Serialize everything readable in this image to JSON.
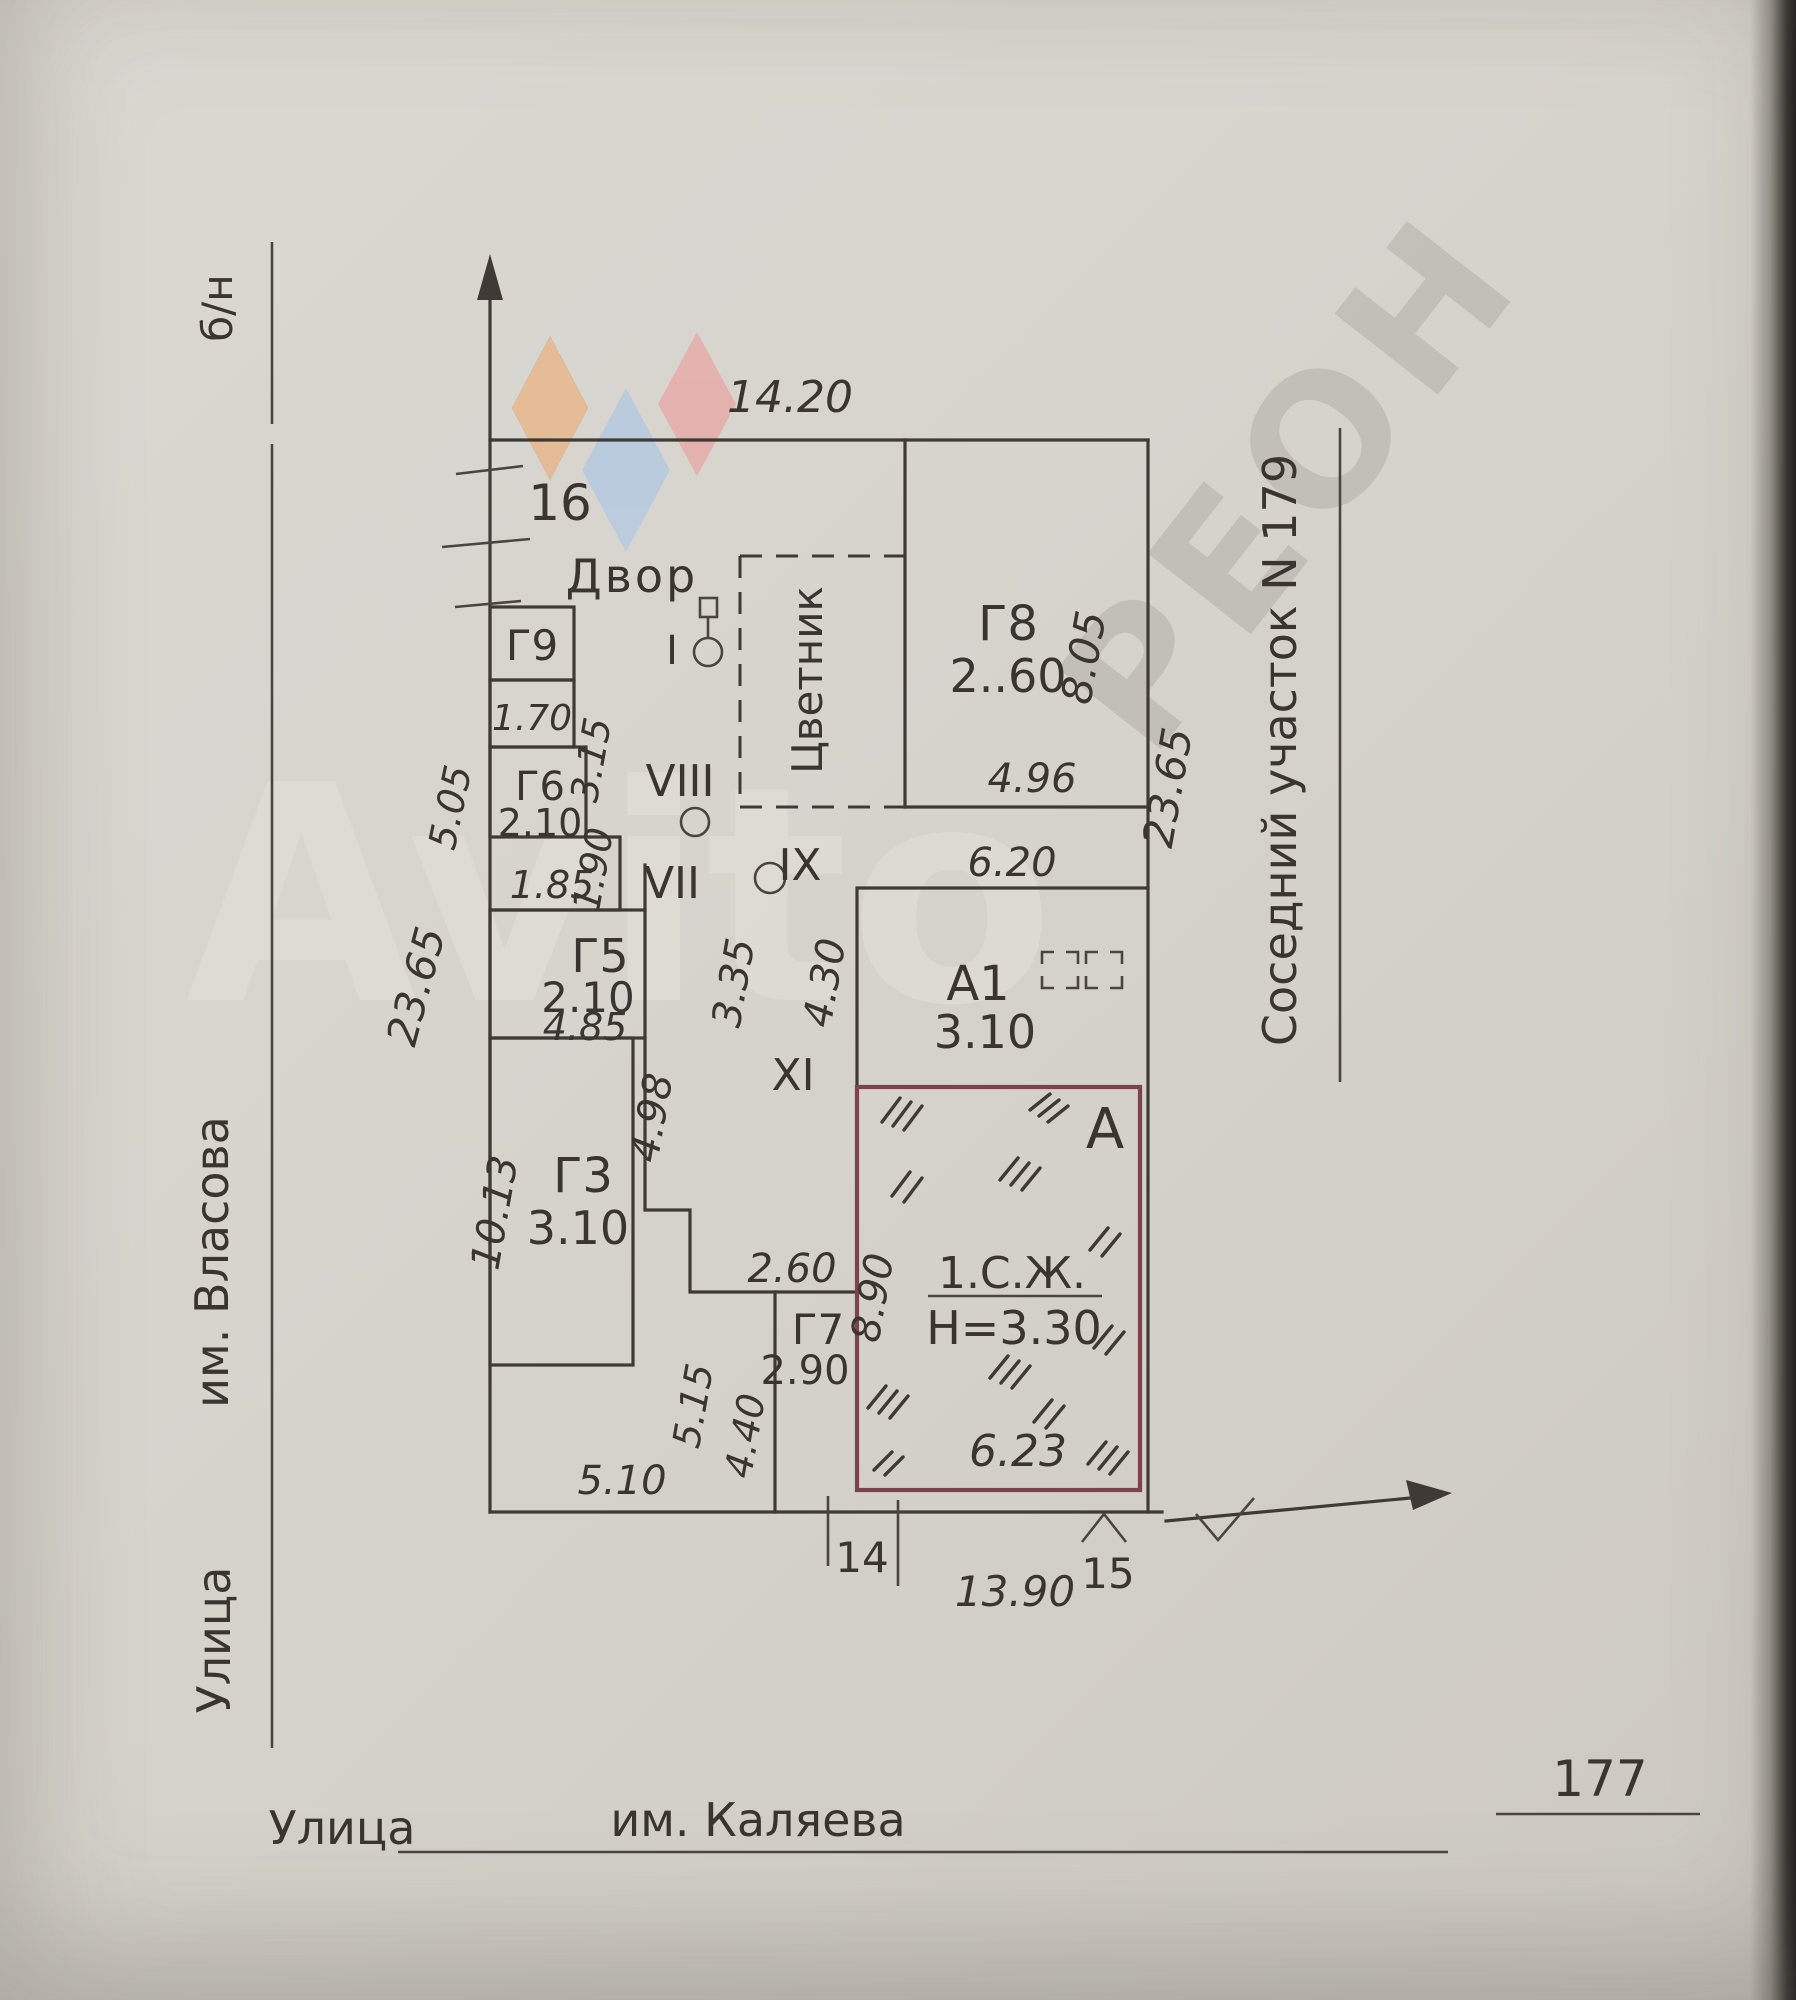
{
  "watermarks": {
    "brand": "Avito",
    "diagonal": "РЕОН"
  },
  "streets": {
    "left_prefix": "Улица",
    "left_name": "им. Власова",
    "left_marker": "б/н",
    "bottom_prefix": "Улица",
    "bottom_name": "им. Каляева",
    "house_number": "177",
    "neighbor": "Соседний участок N 179"
  },
  "boundary": {
    "top_width": "14.20",
    "left_depth": "23.65",
    "right_depth": "23.65",
    "front_width": "13.90",
    "front_left": "5.10",
    "point_top": "16",
    "point_left": "14",
    "point_right": "15"
  },
  "yard": {
    "label": "Двор",
    "flowerbed": "Цветник",
    "well": "I"
  },
  "rooms": {
    "viii": "VIII",
    "vii": "VII",
    "ix": "IX",
    "xi": "XI"
  },
  "dims": {
    "d505": "5.05",
    "d315": "3.15",
    "d190": "1.90",
    "d185": "1.85",
    "d335": "3.35",
    "d430": "4.30",
    "d498": "4.98",
    "d515": "5.15",
    "d440": "4.40",
    "d260": "2.60",
    "d890": "8.90"
  },
  "buildings": {
    "g9": {
      "label": "Г9",
      "d": "1.70"
    },
    "g6": {
      "label": "Г6",
      "d": "2.10"
    },
    "g5": {
      "label": "Г5",
      "d1": "2.10",
      "d2": "4.85"
    },
    "g3": {
      "label": "Г3",
      "d1": "3.10",
      "d2": "10.13"
    },
    "g7": {
      "label": "Г7",
      "d": "2.90"
    },
    "g8": {
      "label": "Г8",
      "d1": "2..60",
      "d2": "8.05",
      "d3": "4.96"
    },
    "a1": {
      "label": "А1",
      "d1": "3.10",
      "d2": "6.20"
    },
    "a": {
      "label": "А",
      "use": "1.С.Ж.",
      "height": "Н=3.30",
      "d1": "6.23"
    }
  }
}
